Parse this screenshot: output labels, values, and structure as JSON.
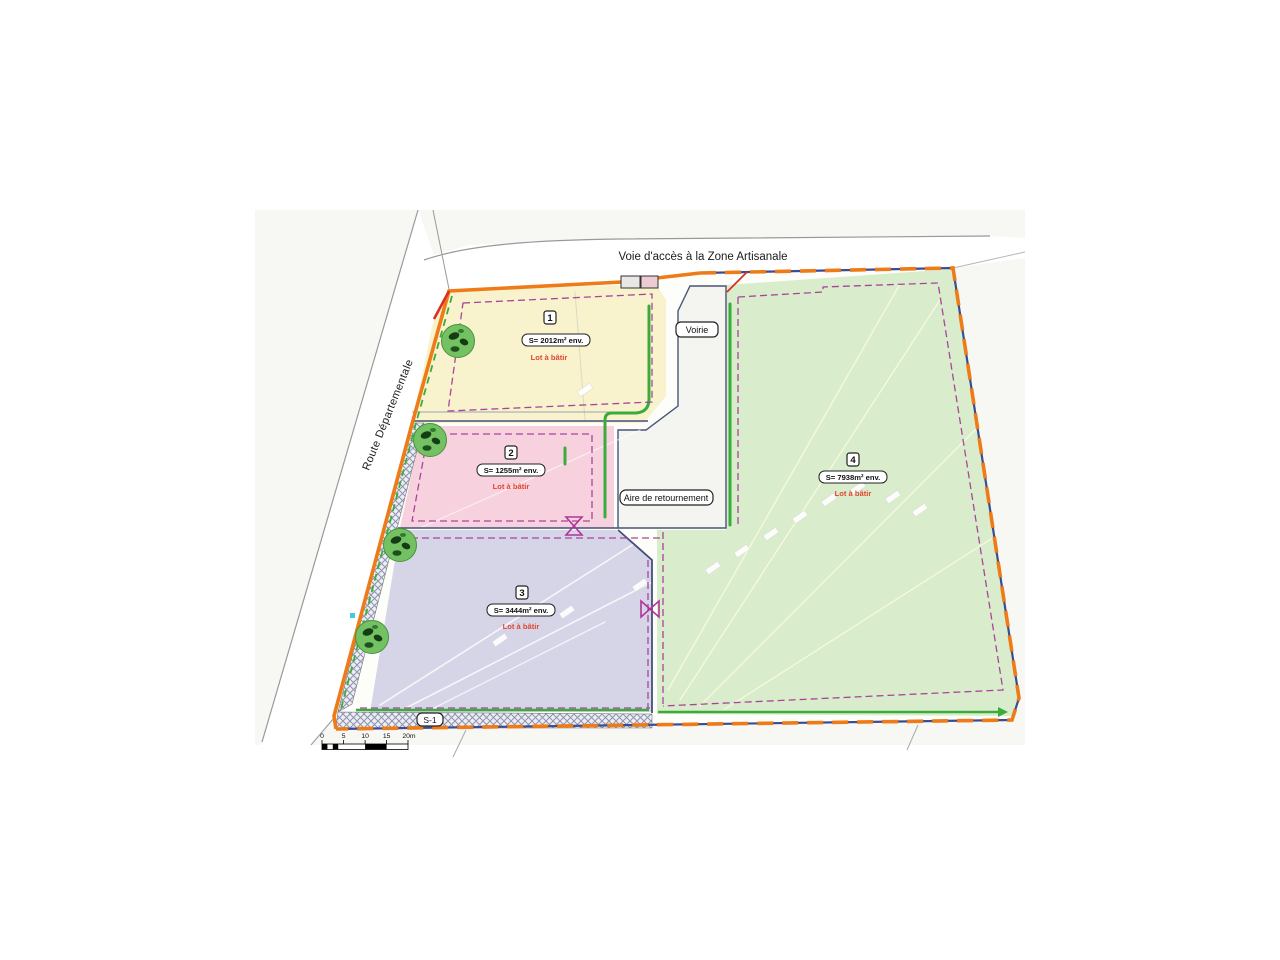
{
  "plan": {
    "access_road_label": "Voie d'accès à la Zone Artisanale",
    "departmental_road_label": "Route Départementale",
    "voirie_label": "Voirie",
    "turning_area_label": "Aire de retournement",
    "section_label": "S-1"
  },
  "lots": [
    {
      "number": "1",
      "area_label": "S= 2012m² env.",
      "status_label": "Lot à bâtir",
      "fill": "#f8f3cd"
    },
    {
      "number": "2",
      "area_label": "S= 1255m² env.",
      "status_label": "Lot à bâtir",
      "fill": "#f7d2de"
    },
    {
      "number": "3",
      "area_label": "S= 3444m² env.",
      "status_label": "Lot à bâtir",
      "fill": "#d6d4e7"
    },
    {
      "number": "4",
      "area_label": "S= 7938m² env.",
      "status_label": "Lot à bâtir",
      "fill": "#d9edcc"
    }
  ],
  "scale_bar": {
    "labels": [
      "0",
      "5",
      "10",
      "15",
      "20m"
    ]
  },
  "colors": {
    "boundary_orange": "#ee7b18",
    "boundary_navy": "#3d4b8f",
    "setback_purple": "#a8459b",
    "green_line": "#3cab3e",
    "status_red": "#e0472e",
    "road_edge_gray": "#999999",
    "tree_green": "#74c163"
  }
}
